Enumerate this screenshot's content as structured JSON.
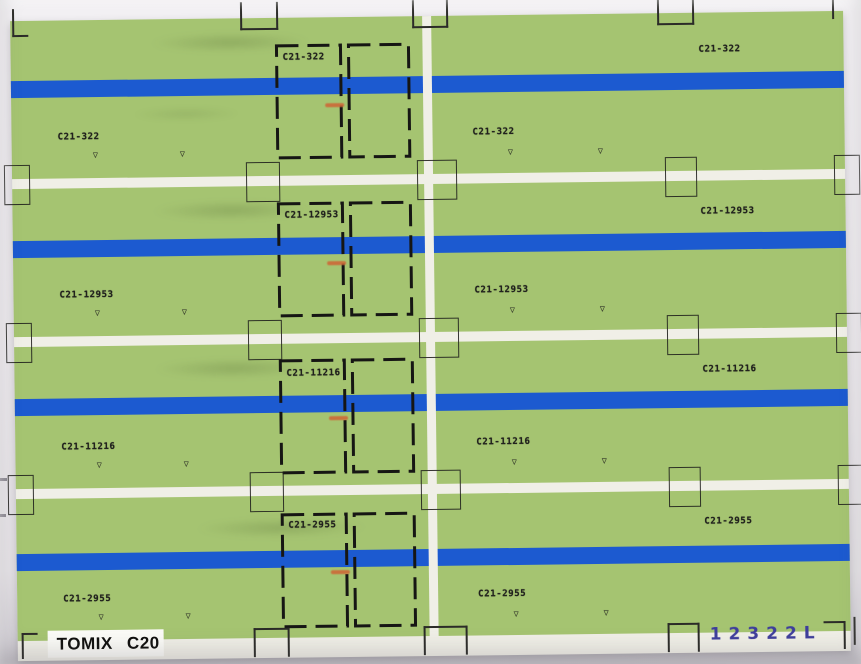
{
  "sheet": {
    "brand_label": "TOMIX C20",
    "serial_label": "12322L",
    "mark_glyph": "▽",
    "bands": [
      {
        "code": "C21-322"
      },
      {
        "code": "C21-12953"
      },
      {
        "code": "C21-11216"
      },
      {
        "code": "C21-2955"
      }
    ],
    "colors": {
      "body_green": "#a5c471",
      "stripe_blue": "#1c5ad0",
      "paper_white": "#f0efe7",
      "cut_mark_black": "#2b2b28",
      "serial_ink": "#3e3e9c",
      "orange_ink": "#cc6a38",
      "photo_background": "#edeaee"
    }
  }
}
